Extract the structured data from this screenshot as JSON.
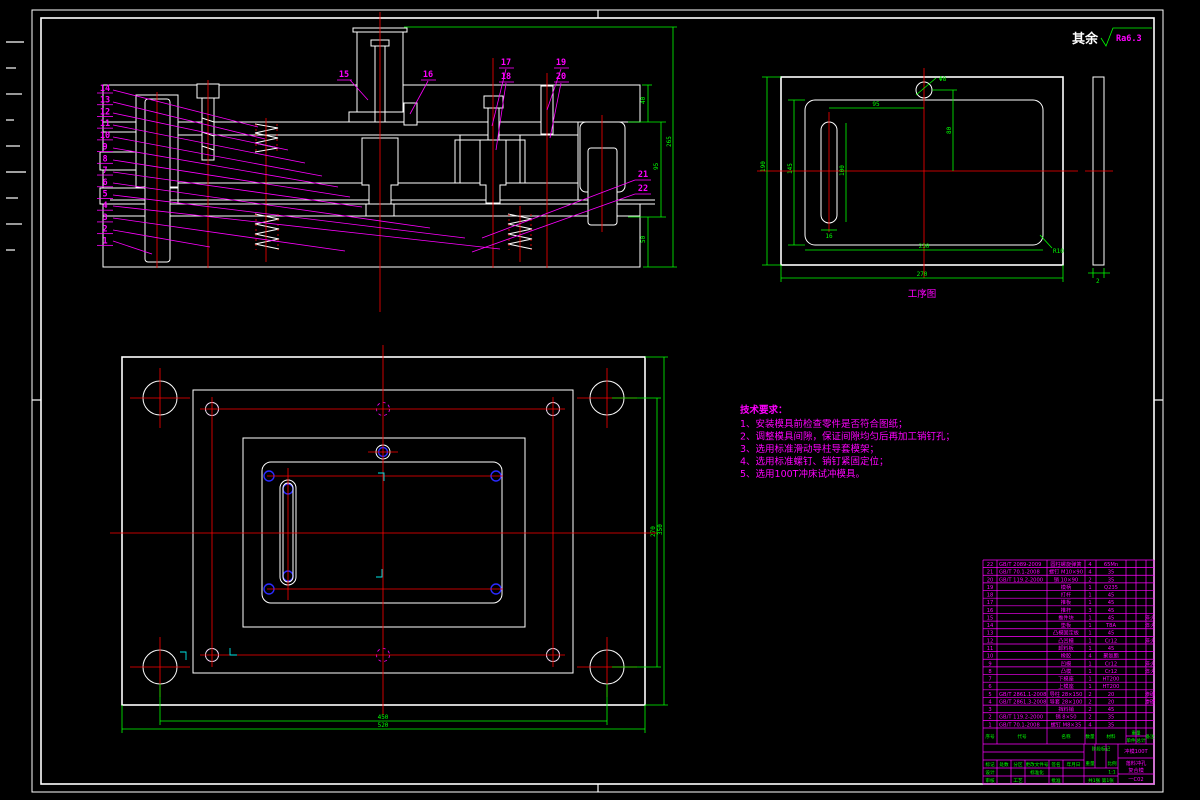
{
  "sheet": {
    "roughness_prefix": "其余",
    "roughness_value": "Ra6.3"
  },
  "section_view": {
    "balloons_left": [
      {
        "label": "14"
      },
      {
        "label": "13"
      },
      {
        "label": "12"
      },
      {
        "label": "11"
      },
      {
        "label": "10"
      },
      {
        "label": "9"
      },
      {
        "label": "8"
      },
      {
        "label": "7"
      },
      {
        "label": "6"
      },
      {
        "label": "5"
      },
      {
        "label": "4"
      },
      {
        "label": "3"
      },
      {
        "label": "2"
      },
      {
        "label": "1"
      }
    ],
    "balloons_top": [
      "15",
      "16",
      "17",
      "18",
      "19",
      "20"
    ],
    "balloons_right": [
      "21",
      "22"
    ],
    "dims": {
      "upper": "40",
      "middle": "95",
      "lower": "50",
      "overall": "265"
    }
  },
  "process_view": {
    "title": "工序图",
    "dims": {
      "overall_w": "270",
      "inner_w": "230",
      "overall_h": "190",
      "inner_h": "145",
      "slot_offset": "95",
      "right_offset": "80",
      "slot_len": "100",
      "slot_w": "16",
      "circle": "Φ8",
      "corner": "R10",
      "thickness": "2"
    }
  },
  "plan_view": {
    "dims": {
      "h_span": "450",
      "h_overall": "520",
      "v_span": "270",
      "v_overall": "350"
    }
  },
  "tech_req": {
    "title": "技术要求：",
    "lines": [
      {
        "t": "1、安装模具前检查零件是否符合图纸；"
      },
      {
        "t": "2、调整模具间隙，保证间隙均匀后再加工销钉孔；"
      },
      {
        "t": "3、选用标准滑动导柱导套模架；"
      },
      {
        "t": "4、选用标准螺钉、销钉紧固定位；"
      },
      {
        "t": "5、选用100T冲床试冲模具。"
      }
    ]
  },
  "bom": {
    "headers": {
      "no": "序号",
      "code": "代号",
      "name": "名称",
      "qty": "数量",
      "mat": "材料",
      "wt": "重量",
      "single": "单件",
      "total": "总计",
      "note": "备注"
    },
    "rows": [
      {
        "no": "22",
        "code": "GB/T 2089-2009",
        "name": "圆柱螺旋弹簧",
        "qty": "4",
        "mat": "65Mn",
        "note": ""
      },
      {
        "no": "21",
        "code": "GB/T 70.1-2008",
        "name": "螺钉 M10×90",
        "qty": "4",
        "mat": "35",
        "note": ""
      },
      {
        "no": "20",
        "code": "GB/T 119.2-2000",
        "name": "销 10×90",
        "qty": "2",
        "mat": "35",
        "note": ""
      },
      {
        "no": "19",
        "code": "",
        "name": "模柄",
        "qty": "1",
        "mat": "Q235",
        "note": ""
      },
      {
        "no": "18",
        "code": "",
        "name": "打杆",
        "qty": "1",
        "mat": "45",
        "note": ""
      },
      {
        "no": "17",
        "code": "",
        "name": "推板",
        "qty": "1",
        "mat": "45",
        "note": ""
      },
      {
        "no": "16",
        "code": "",
        "name": "推杆",
        "qty": "3",
        "mat": "45",
        "note": ""
      },
      {
        "no": "15",
        "code": "",
        "name": "推件块",
        "qty": "1",
        "mat": "45",
        "note": "淬火"
      },
      {
        "no": "14",
        "code": "",
        "name": "垫板",
        "qty": "1",
        "mat": "T8A",
        "note": "淬火"
      },
      {
        "no": "13",
        "code": "",
        "name": "凸模固定板",
        "qty": "1",
        "mat": "45",
        "note": ""
      },
      {
        "no": "12",
        "code": "",
        "name": "凸凹模",
        "qty": "1",
        "mat": "Cr12",
        "note": "淬火"
      },
      {
        "no": "11",
        "code": "",
        "name": "卸料板",
        "qty": "1",
        "mat": "45",
        "note": ""
      },
      {
        "no": "10",
        "code": "",
        "name": "橡胶",
        "qty": "4",
        "mat": "聚氨酯",
        "note": ""
      },
      {
        "no": "9",
        "code": "",
        "name": "凹模",
        "qty": "1",
        "mat": "Cr12",
        "note": "淬火"
      },
      {
        "no": "8",
        "code": "",
        "name": "凸模",
        "qty": "1",
        "mat": "Cr12",
        "note": "淬火"
      },
      {
        "no": "7",
        "code": "",
        "name": "下模座",
        "qty": "1",
        "mat": "HT200",
        "note": ""
      },
      {
        "no": "6",
        "code": "",
        "name": "上模座",
        "qty": "1",
        "mat": "HT200",
        "note": ""
      },
      {
        "no": "5",
        "code": "GB/T 2861.1-2008",
        "name": "导柱 28×150",
        "qty": "2",
        "mat": "20",
        "note": "渗碳"
      },
      {
        "no": "4",
        "code": "GB/T 2861.3-2008",
        "name": "导套 28×100",
        "qty": "2",
        "mat": "20",
        "note": "渗碳"
      },
      {
        "no": "3",
        "code": "",
        "name": "挡料销",
        "qty": "2",
        "mat": "45",
        "note": ""
      },
      {
        "no": "2",
        "code": "GB/T 119.2-2000",
        "name": "销 8×50",
        "qty": "2",
        "mat": "35",
        "note": ""
      },
      {
        "no": "1",
        "code": "GB/T 70.1-2008",
        "name": "螺钉 M8×35",
        "qty": "4",
        "mat": "35",
        "note": ""
      }
    ]
  },
  "titleblock": {
    "mark": "标记",
    "count": "处数",
    "zone": "分区",
    "doc": "更改文件号",
    "sig": "签名",
    "date": "年月日",
    "design": "设计",
    "stdz": "标准化",
    "audit": "审核",
    "process": "工艺",
    "approve": "批准",
    "stage": "阶段标记",
    "weight": "重量",
    "scale": "比例",
    "scale_val": "1:1",
    "sheets": "共1张 第1张",
    "name1": "冲模100T",
    "name2": "落料冲孔",
    "name3": "复合模",
    "dwgno": "一C02"
  }
}
